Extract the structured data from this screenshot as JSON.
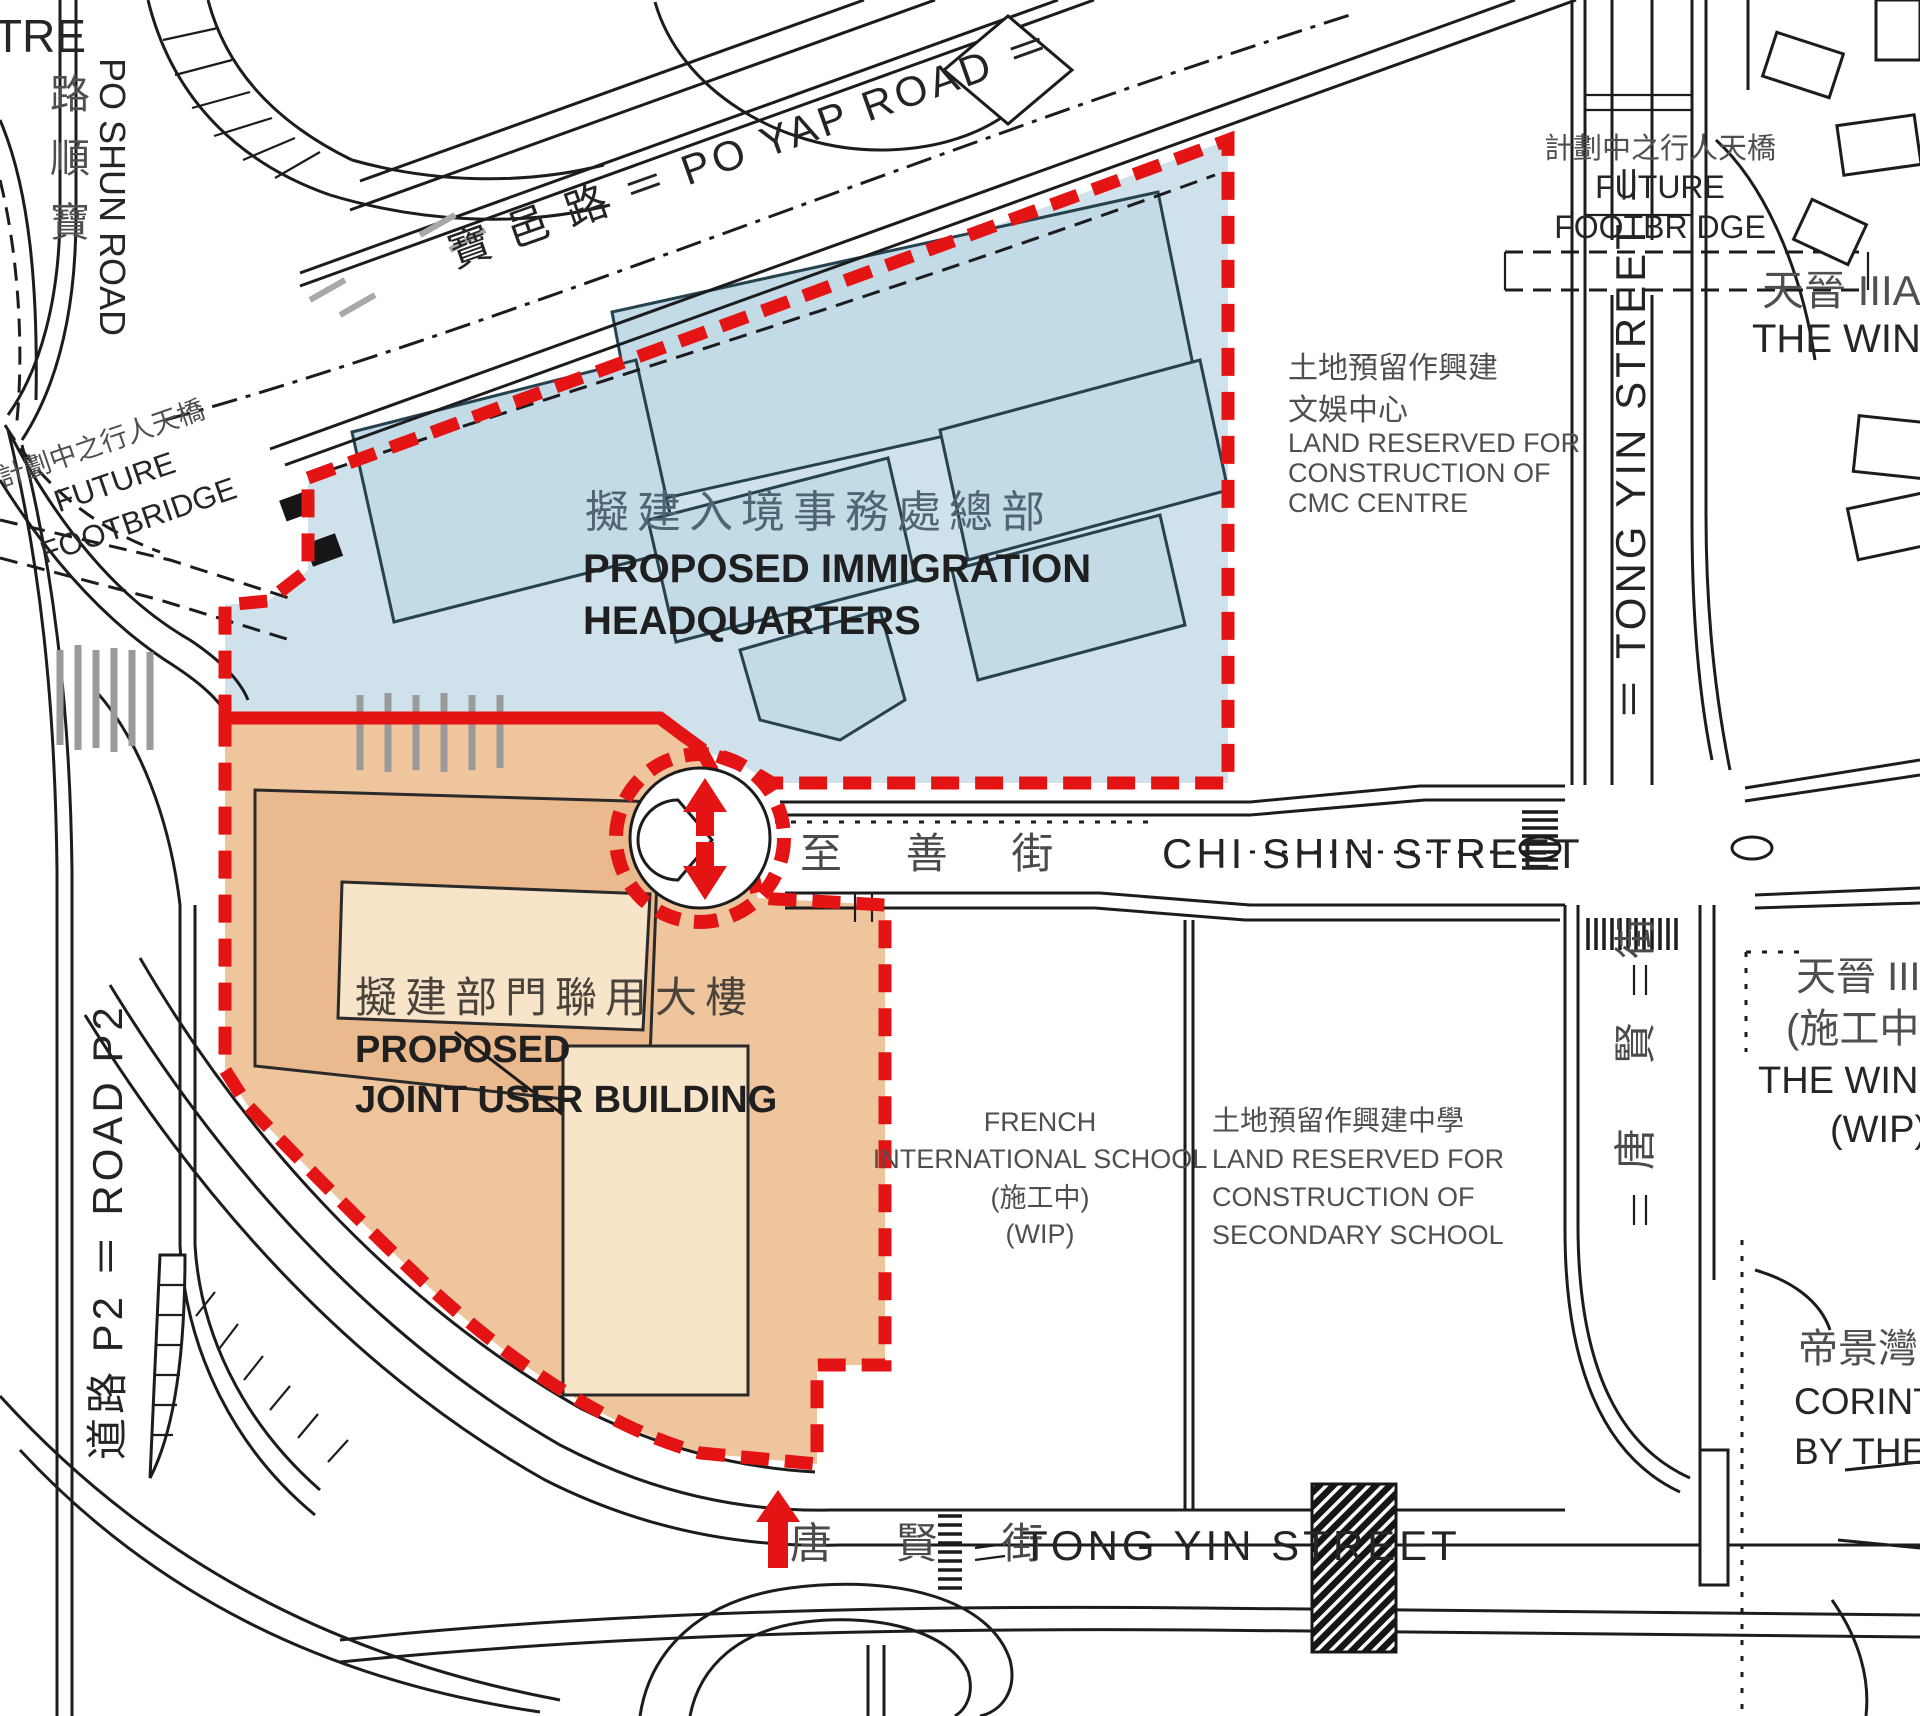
{
  "map_type": "site-plan",
  "colors": {
    "boundary_red": "#e41414",
    "zone_immigration_fill": "#cfe2ec",
    "zone_immigration_building": "#c3dae7",
    "zone_joint_user_fill": "#efc59d",
    "zone_joint_user_building": "#f7e4c9",
    "zone_joint_user_building_dark": "#eab98d",
    "road_line": "#1c1c1c",
    "text_dark": "#262626",
    "text_grey": "#4f4f4f",
    "hatch_grey": "#9a9a9a"
  },
  "zones": {
    "immigration": {
      "label_cn": "擬建入境事務處總部",
      "label_en_1": "PROPOSED IMMIGRATION",
      "label_en_2": "HEADQUARTERS"
    },
    "joint_user": {
      "label_cn": "擬建部門聯用大樓",
      "label_en_1": "PROPOSED",
      "label_en_2": "JOINT USER BUILDING"
    }
  },
  "streets": {
    "po_yap_road": "寶 邑 路 ＝ PO YAP ROAD ＝",
    "po_shun_road_en": "PO SHUN ROAD",
    "po_shun_road_cn_chars": [
      "路",
      "順",
      "寶"
    ],
    "tong_yin_street_upper": "＝ TONG YIN STREET ＝",
    "chi_shin_street_cn": "至 善 街",
    "chi_shin_street_en": "CHI SHIN STREET",
    "tong_yin_street_lower_cn": "唐 賢 街",
    "tong_yin_bottom_cn": "唐 賢 街",
    "tong_yin_bottom_en": "TONG YIN STREET",
    "road_p2": "道路 P2 ＝ ROAD P2"
  },
  "labels": {
    "centre_partial": "TRE",
    "future_footbridge_cn": "計劃中之行人天橋",
    "future_footbridge_en_1": "FUTURE",
    "future_footbridge_en_2": "FOOTBRIDGE",
    "cmc_lines": [
      "土地預留作興建",
      "文娛中心",
      "LAND RESERVED FOR",
      "CONSTRUCTION OF",
      "CMC CENTRE"
    ],
    "french_school_lines": [
      "FRENCH",
      "INTERNATIONAL SCHOOL",
      "(施工中)",
      "(WIP)"
    ],
    "secondary_school_lines": [
      "土地預留作興建中學",
      "LAND RESERVED FOR",
      "CONSTRUCTION OF",
      "SECONDARY SCHOOL"
    ],
    "wings_iiia_cn": "天晉 IIIA",
    "wings_iiia_en": "THE WINGS",
    "wings_iii_wip_lines": [
      "天晉 III",
      "(施工中",
      "THE WINGS",
      "(WIP)"
    ],
    "corinthia_lines": [
      "帝景灣",
      "CORINTH",
      "BY THE"
    ]
  }
}
